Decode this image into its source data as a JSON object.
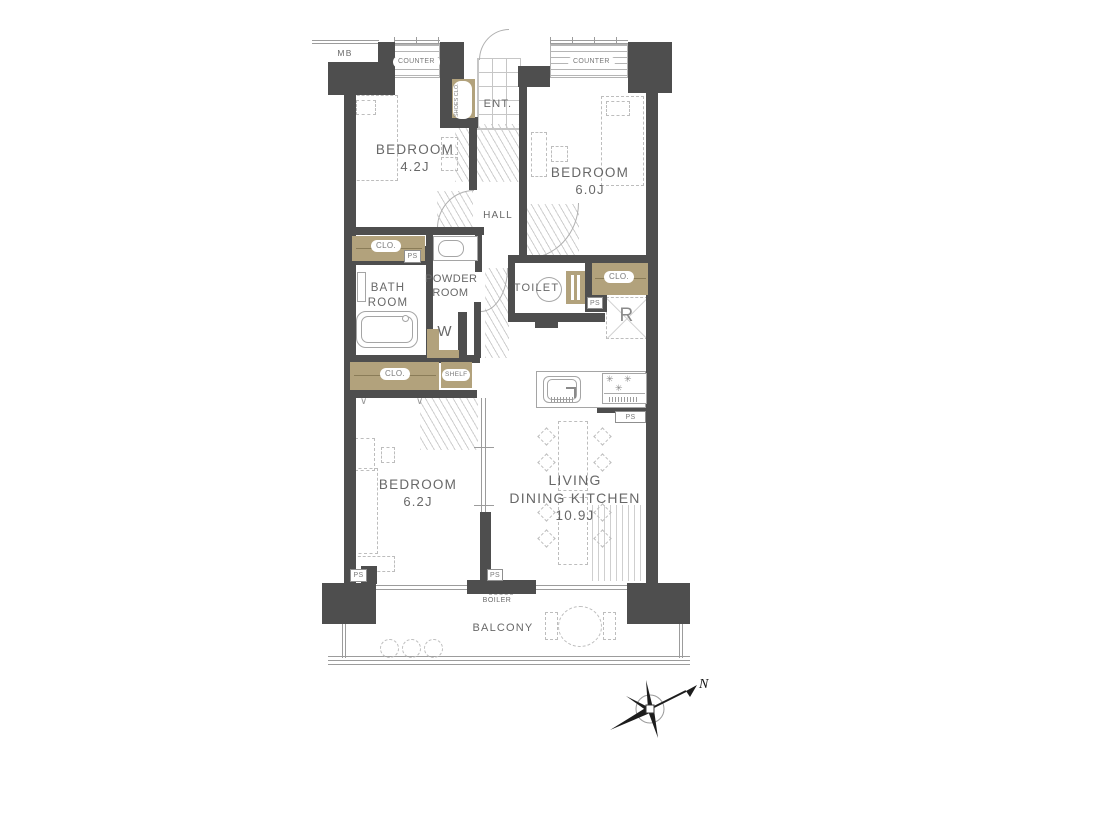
{
  "plan_title": "apartment-floor-plan",
  "colors": {
    "wall": "#4e4e4e",
    "closet_fill": "#b2a27c",
    "line": "#9c9c9c",
    "text": "#686868"
  },
  "rooms": {
    "bedroom1": {
      "name": "BEDROOM",
      "area": "4.2J"
    },
    "bedroom2": {
      "name": "BEDROOM",
      "area": "6.0J"
    },
    "bedroom3": {
      "name": "BEDROOM",
      "area": "6.2J"
    },
    "ldk": {
      "line1": "LIVING",
      "line2": "DINING KITCHEN",
      "area": "10.9J"
    },
    "bath": {
      "line1": "BATH",
      "line2": "ROOM"
    },
    "powder": {
      "line1": "POWDER",
      "line2": "ROOM"
    },
    "toilet": {
      "name": "TOILET"
    },
    "hall": {
      "name": "HALL"
    },
    "entrance": {
      "name": "ENT."
    },
    "balcony": {
      "name": "BALCONY"
    }
  },
  "fixtures": {
    "mb": "MB",
    "counter": "COUNTER",
    "shoes_closet": "SHOES CLO.",
    "closet": "CLO.",
    "shelf": "SHELF",
    "washer": "W",
    "refrigerator": "R",
    "ps": "PS",
    "boiler": "BOILER",
    "compass_north": "N"
  },
  "icons": {
    "burner": "✳",
    "door_mark": "∨"
  }
}
